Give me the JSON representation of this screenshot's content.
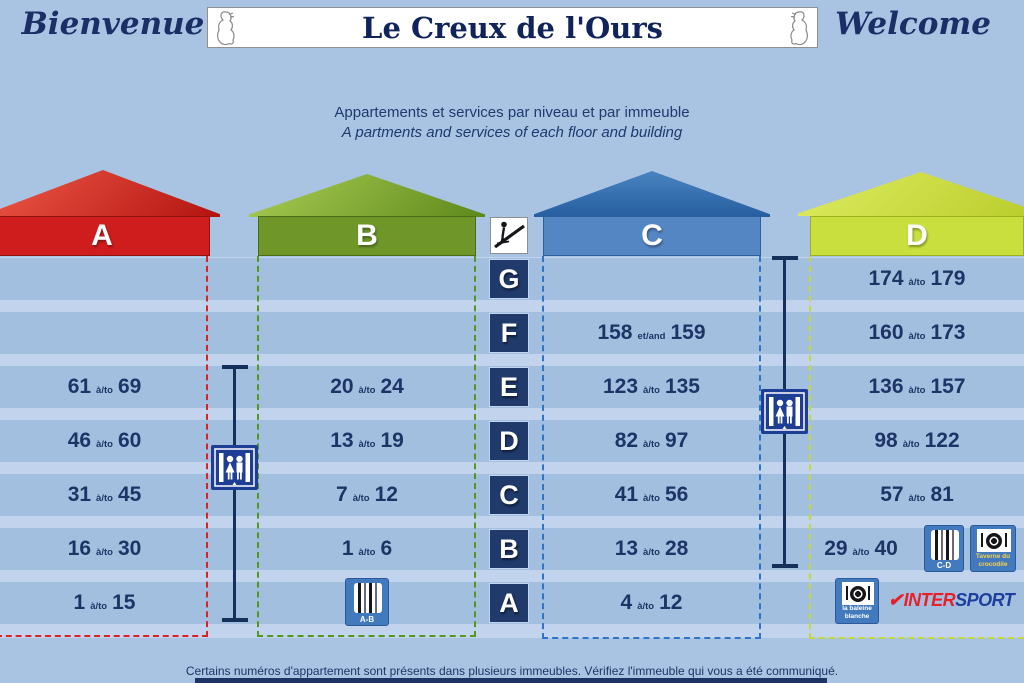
{
  "colors": {
    "background": "#a9c3e3",
    "stripe_light": "#c2d4ed",
    "stripe_band": "#a3bfe0",
    "text_navy": "#1d3566",
    "building_a_red": "#cf1d1d",
    "building_b_green": "#6e9629",
    "building_c_blue": "#5586c4",
    "building_d_chartreuse": "#c9df3e",
    "floor_square_navy": "#1f3a6b",
    "elevator_blue": "#1e3d94",
    "service_icon_blue": "#4379bd",
    "intersport_red": "#e8202a",
    "intersport_blue": "#1d3f9e"
  },
  "header": {
    "left_greeting": "Bienvenue",
    "title": "Le Creux de l'Ours",
    "right_greeting": "Welcome"
  },
  "subtitle": {
    "line_fr": "Appartements et services par niveau et par immeuble",
    "line_en": "A partments and services of each floor and building"
  },
  "floor_letters": [
    "G",
    "F",
    "E",
    "D",
    "C",
    "B",
    "A"
  ],
  "buildings": [
    {
      "label": "A",
      "apartments": [
        null,
        null,
        {
          "from": "61",
          "sep": "à/to",
          "to": "69"
        },
        {
          "from": "46",
          "sep": "à/to",
          "to": "60"
        },
        {
          "from": "31",
          "sep": "à/to",
          "to": "45"
        },
        {
          "from": "16",
          "sep": "à/to",
          "to": "30"
        },
        {
          "from": "1",
          "sep": "à/to",
          "to": "15"
        }
      ]
    },
    {
      "label": "B",
      "apartments": [
        null,
        null,
        {
          "from": "20",
          "sep": "à/to",
          "to": "24"
        },
        {
          "from": "13",
          "sep": "à/to",
          "to": "19"
        },
        {
          "from": "7",
          "sep": "à/to",
          "to": "12"
        },
        {
          "from": "1",
          "sep": "à/to",
          "to": "6"
        },
        null
      ]
    },
    {
      "label": "C",
      "apartments": [
        null,
        {
          "from": "158",
          "sep": "et/and",
          "to": "159"
        },
        {
          "from": "123",
          "sep": "à/to",
          "to": "135"
        },
        {
          "from": "82",
          "sep": "à/to",
          "to": "97"
        },
        {
          "from": "41",
          "sep": "à/to",
          "to": "56"
        },
        {
          "from": "13",
          "sep": "à/to",
          "to": "28"
        },
        {
          "from": "4",
          "sep": "à/to",
          "to": "12"
        }
      ]
    },
    {
      "label": "D",
      "apartments": [
        {
          "from": "174",
          "sep": "à/to",
          "to": "179"
        },
        {
          "from": "160",
          "sep": "à/to",
          "to": "173"
        },
        {
          "from": "136",
          "sep": "à/to",
          "to": "157"
        },
        {
          "from": "98",
          "sep": "à/to",
          "to": "122"
        },
        {
          "from": "57",
          "sep": "à/to",
          "to": "81"
        },
        {
          "from": "29",
          "sep": "à/to",
          "to": "40"
        },
        null
      ]
    }
  ],
  "services": {
    "ski_room_ab": {
      "label": "A-B"
    },
    "ski_room_cd": {
      "label": "C-D"
    },
    "restaurant_taverne": {
      "line1": "Taverne du",
      "line2": "crocodile"
    },
    "restaurant_baleine": {
      "line1": "la baleine",
      "line2": "blanche"
    },
    "intersport": {
      "check_icon": "✔",
      "part1": "INTER",
      "part2": "SPORT"
    }
  },
  "footer": {
    "notice": "Certains numéros d'appartement sont présents dans plusieurs immeubles. Vérifiez l'immeuble qui vous a été communiqué."
  }
}
